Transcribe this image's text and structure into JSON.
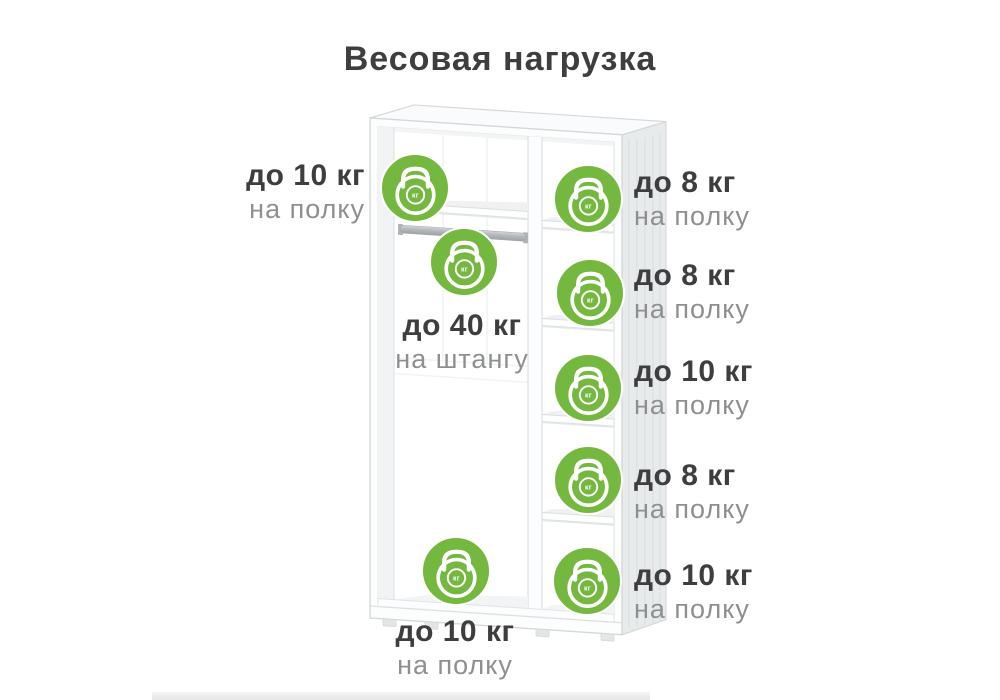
{
  "title": "Весовая нагрузка",
  "icon_label": "кг",
  "colors": {
    "badge_green": "#75b83f",
    "dark_text": "#3e3e40",
    "muted_text": "#8d8f91"
  },
  "annotations": {
    "top_shelf_left": {
      "limit": "до 10 кг",
      "target": "на полку"
    },
    "hanging_rod": {
      "limit": "до 40 кг",
      "target": "на штангу"
    },
    "bottom_shelf": {
      "limit": "до 10 кг",
      "target": "на полку"
    },
    "right_shelves": [
      {
        "limit": "до 8 кг",
        "target": "на полку"
      },
      {
        "limit": "до 8 кг",
        "target": "на полку"
      },
      {
        "limit": "до 10 кг",
        "target": "на полку"
      },
      {
        "limit": "до 8 кг",
        "target": "на полку"
      },
      {
        "limit": "до 10 кг",
        "target": "на полку"
      }
    ]
  }
}
